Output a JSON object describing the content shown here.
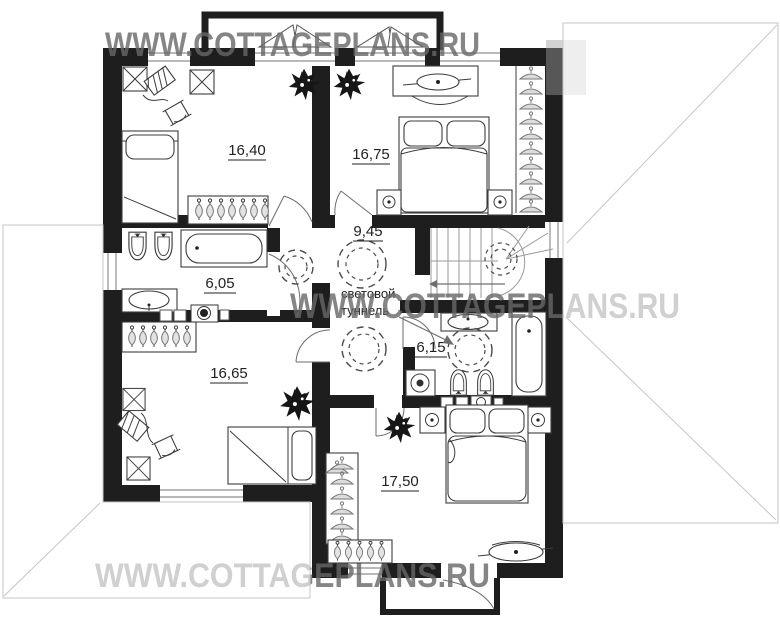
{
  "watermarks": {
    "top": "WWW.COTTAGEPLANS.RU",
    "middle": "WWW.COTTAGEPLANS.RU",
    "bottom": "WWW.COTTAGEPLANS.RU"
  },
  "rooms": {
    "bedroom_top_left": {
      "area": "16,40"
    },
    "bedroom_top_right": {
      "area": "16,75"
    },
    "hall": {
      "area": "9,45"
    },
    "bathroom_left": {
      "area": "6,05"
    },
    "bathroom_right": {
      "area": "6,15"
    },
    "bedroom_bottom_left": {
      "area": "16,65"
    },
    "bedroom_bottom_right": {
      "area": "17,50"
    }
  },
  "annotations": {
    "light_tunnel_line1": "световой",
    "light_tunnel_line2": "туннель"
  },
  "colors": {
    "wall": "#1e1e1e",
    "furniture_stroke": "#3c3c3c",
    "watermark": "#666666",
    "roof_line": "#c6c6c6",
    "label": "#222222"
  }
}
